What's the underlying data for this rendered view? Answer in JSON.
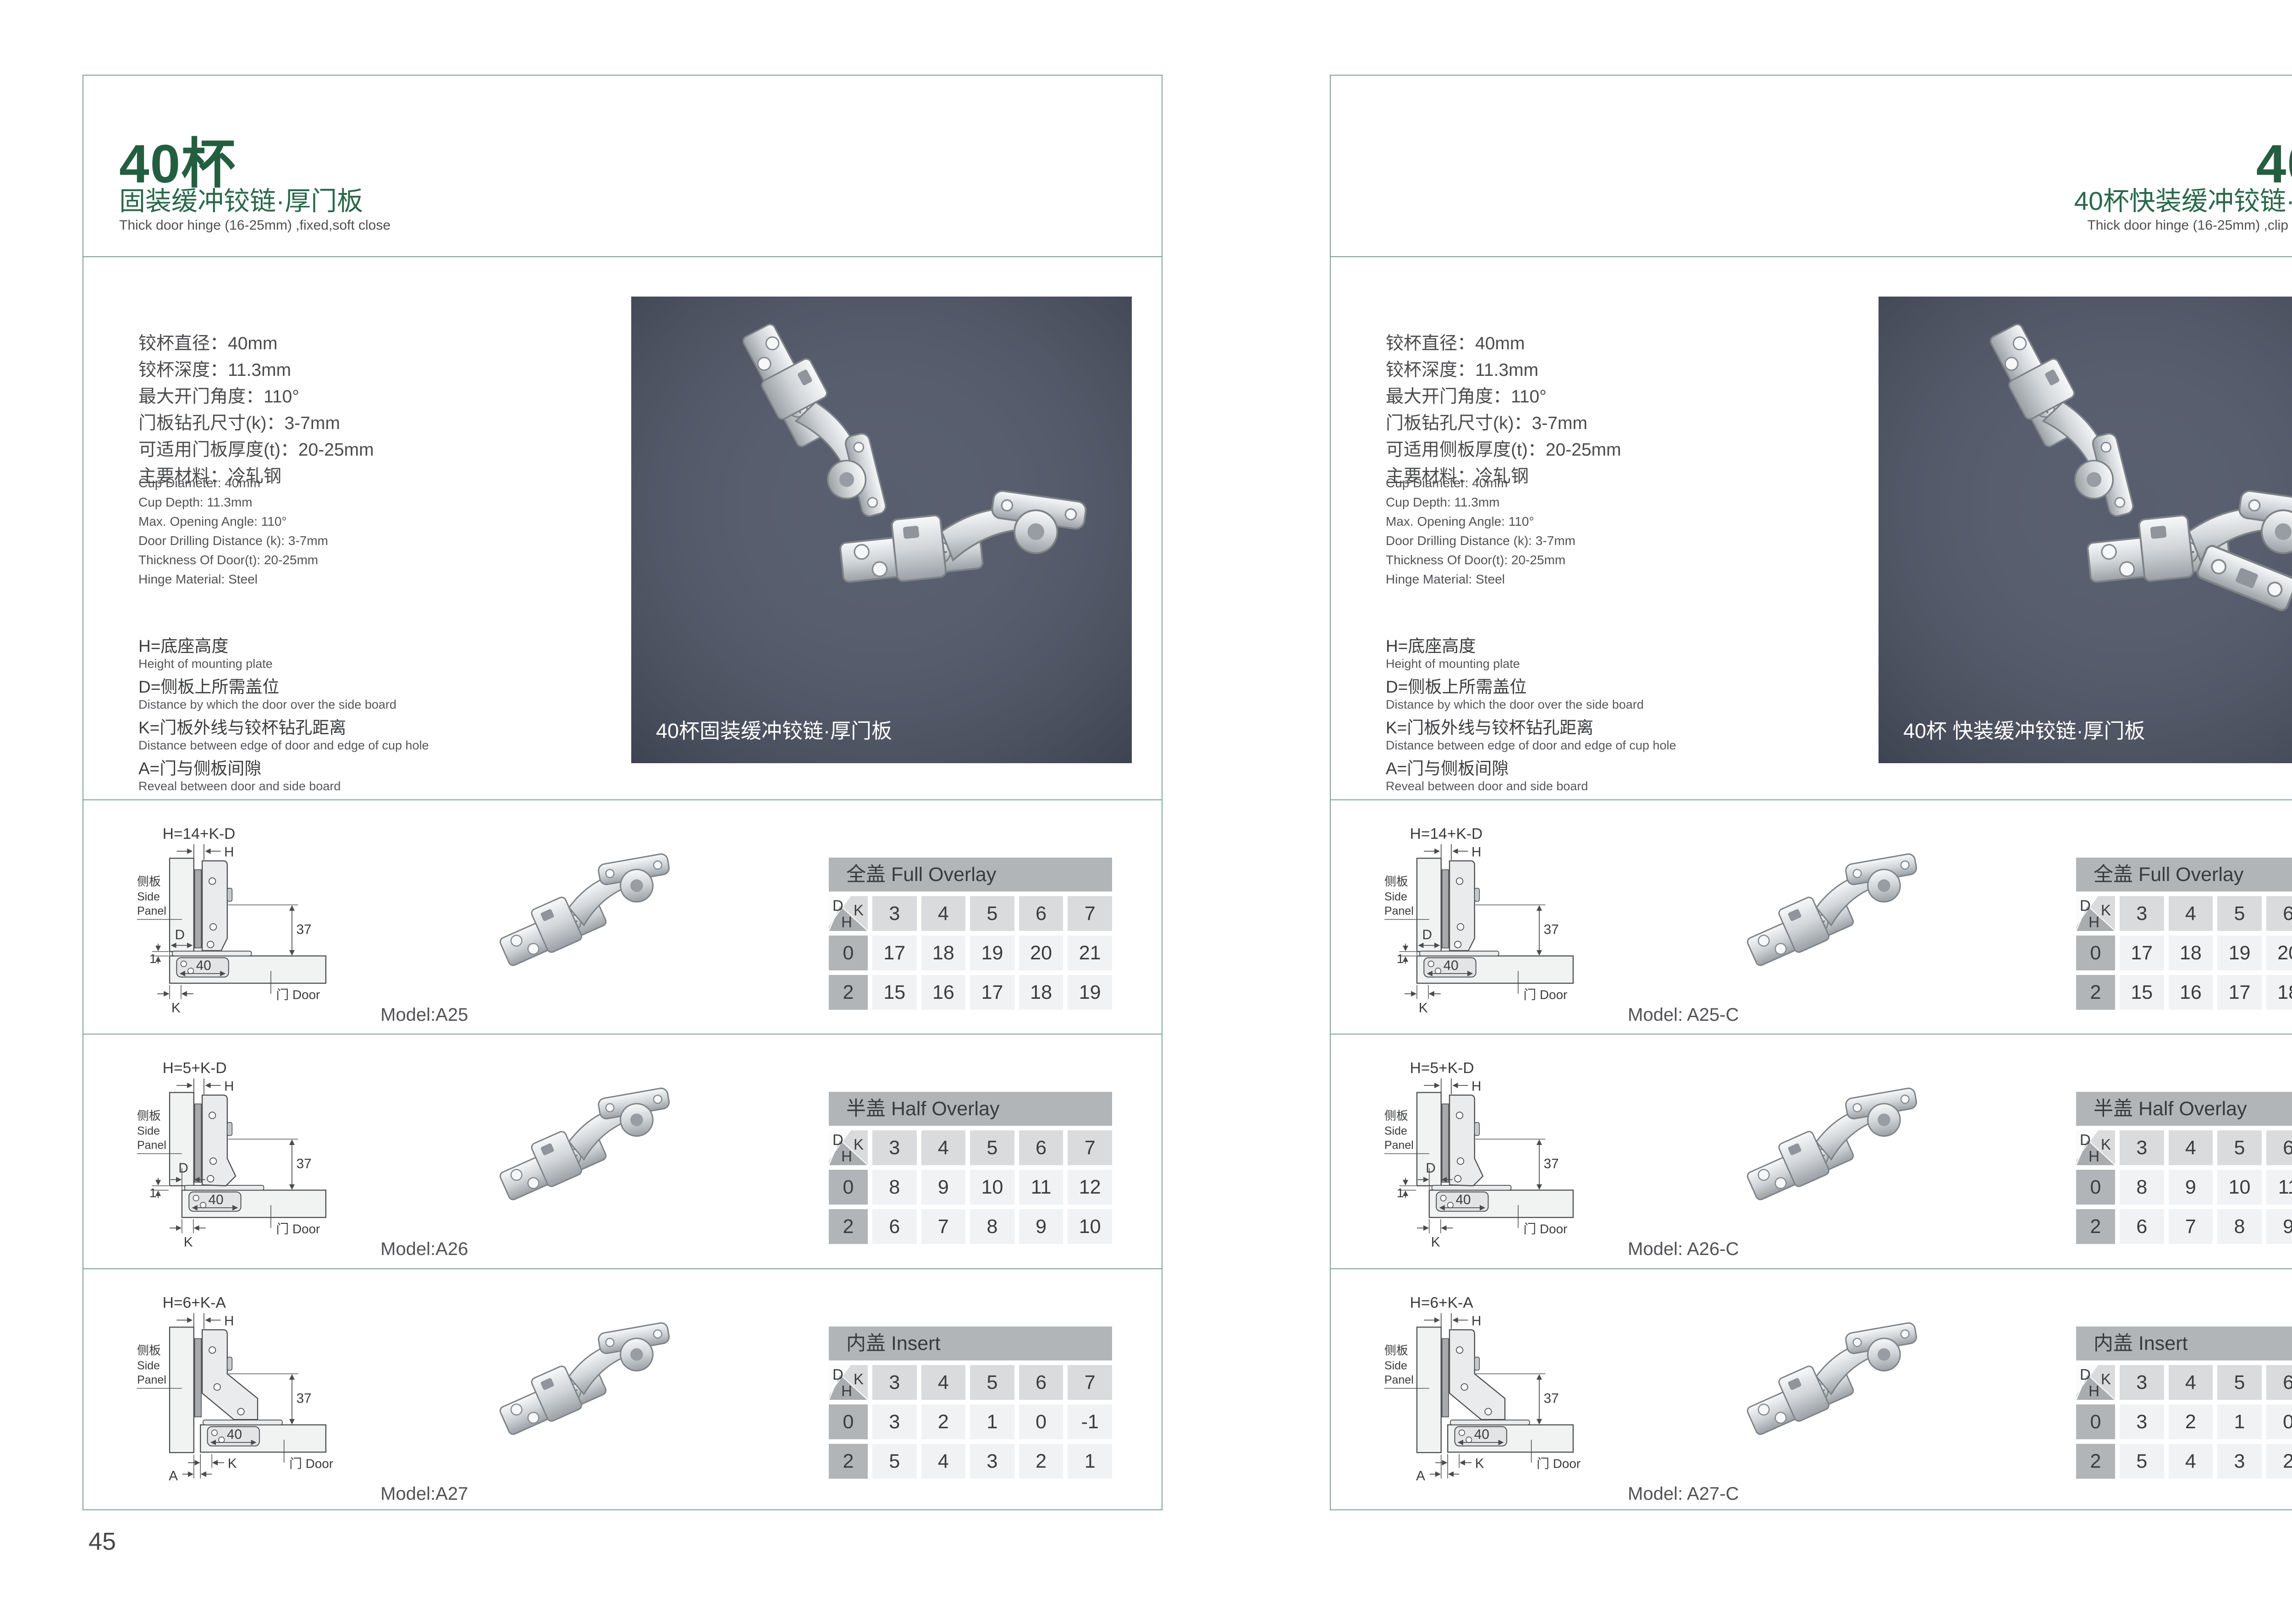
{
  "colors": {
    "accent_green": "#245e41",
    "border_green": "#7ca391",
    "photo_bg": "#4e5566",
    "table_title_bg": "#b1b5b8",
    "table_header_bg": "#d9dbdc",
    "table_label_bg": "#b1b5b8",
    "table_cell_bg": "#f1f2f3"
  },
  "pages": [
    {
      "page_number": "45",
      "title": "40杯",
      "subtitle": "固装缓冲铰链·厚门板",
      "subtitle_en": "Thick door hinge (16-25mm)  ,fixed,soft close",
      "specs_cn": [
        "铰杯直径：40mm",
        "铰杯深度：11.3mm",
        "最大开门角度：110°",
        "门板钻孔尺寸(k)：3-7mm",
        "可适用门板厚度(t)：20-25mm",
        "主要材料：冷轧钢"
      ],
      "specs_en": [
        "Cup Diameter: 40mm",
        "Cup Depth: 11.3mm",
        "Max. Opening Angle: 110°",
        "Door Drilling Distance (k): 3-7mm",
        "Thickness Of Door(t): 20-25mm",
        "Hinge Material: Steel"
      ],
      "legend": [
        {
          "cn": "H=底座高度",
          "en": "Height of mounting plate"
        },
        {
          "cn": "D=侧板上所需盖位",
          "en": "Distance by which the door over the side board"
        },
        {
          "cn": "K=门板外线与铰杯钻孔距离",
          "en": "Distance between edge of door and edge of cup hole"
        },
        {
          "cn": "A=门与侧板间隙",
          "en": "Reveal between door and side board"
        }
      ],
      "photo_caption": "40杯固装缓冲铰链·厚门板",
      "hinge_type": "fixed",
      "rows": [
        {
          "formula": "H=14+K-D",
          "model": "Model:A25",
          "diagram": "full-overlay",
          "table": {
            "title": "全盖 Full Overlay",
            "k_values": [
              "3",
              "4",
              "5",
              "6",
              "7"
            ],
            "rows": [
              {
                "h": "0",
                "values": [
                  "17",
                  "18",
                  "19",
                  "20",
                  "21"
                ]
              },
              {
                "h": "2",
                "values": [
                  "15",
                  "16",
                  "17",
                  "18",
                  "19"
                ]
              }
            ]
          }
        },
        {
          "formula": "H=5+K-D",
          "model": "Model:A26",
          "diagram": "half-overlay",
          "table": {
            "title": "半盖 Half Overlay",
            "k_values": [
              "3",
              "4",
              "5",
              "6",
              "7"
            ],
            "rows": [
              {
                "h": "0",
                "values": [
                  "8",
                  "9",
                  "10",
                  "11",
                  "12"
                ]
              },
              {
                "h": "2",
                "values": [
                  "6",
                  "7",
                  "8",
                  "9",
                  "10"
                ]
              }
            ]
          }
        },
        {
          "formula": "H=6+K-A",
          "model": "Model:A27",
          "diagram": "insert",
          "table": {
            "title": "内盖 Insert",
            "k_values": [
              "3",
              "4",
              "5",
              "6",
              "7"
            ],
            "rows": [
              {
                "h": "0",
                "values": [
                  "3",
                  "2",
                  "1",
                  "0",
                  "-1"
                ]
              },
              {
                "h": "2",
                "values": [
                  "5",
                  "4",
                  "3",
                  "2",
                  "1"
                ]
              }
            ]
          }
        }
      ]
    },
    {
      "page_number": "46",
      "title": "40杯",
      "subtitle": "40杯快装缓冲铰链·厚门板",
      "subtitle_en": "Thick door hinge (16-25mm)  ,clip on ,soft close",
      "specs_cn": [
        "铰杯直径：40mm",
        "铰杯深度：11.3mm",
        "最大开门角度：110°",
        "门板钻孔尺寸(k)：3-7mm",
        "可适用侧板厚度(t)：20-25mm",
        "主要材料：冷轧钢"
      ],
      "specs_en": [
        "Cup Diameter: 40mm",
        "Cup Depth: 11.3mm",
        "Max. Opening Angle: 110°",
        "Door Drilling Distance (k): 3-7mm",
        "Thickness Of Door(t): 20-25mm",
        "Hinge Material: Steel"
      ],
      "legend": [
        {
          "cn": "H=底座高度",
          "en": "Height of mounting plate"
        },
        {
          "cn": "D=侧板上所需盖位",
          "en": "Distance by which the door over the side board"
        },
        {
          "cn": "K=门板外线与铰杯钻孔距离",
          "en": "Distance between edge of door and edge of cup hole"
        },
        {
          "cn": "A=门与侧板间隙",
          "en": "Reveal between door and side board"
        }
      ],
      "photo_caption": "40杯 快装缓冲铰链·厚门板",
      "hinge_type": "clip",
      "rows": [
        {
          "formula": "H=14+K-D",
          "model": "Model: A25-C",
          "diagram": "full-overlay",
          "table": {
            "title": "全盖 Full Overlay",
            "k_values": [
              "3",
              "4",
              "5",
              "6",
              "7"
            ],
            "rows": [
              {
                "h": "0",
                "values": [
                  "17",
                  "18",
                  "19",
                  "20",
                  "21"
                ]
              },
              {
                "h": "2",
                "values": [
                  "15",
                  "16",
                  "17",
                  "18",
                  "19"
                ]
              }
            ]
          }
        },
        {
          "formula": "H=5+K-D",
          "model": "Model: A26-C",
          "diagram": "half-overlay",
          "table": {
            "title": "半盖 Half Overlay",
            "k_values": [
              "3",
              "4",
              "5",
              "6",
              "7"
            ],
            "rows": [
              {
                "h": "0",
                "values": [
                  "8",
                  "9",
                  "10",
                  "11",
                  "12"
                ]
              },
              {
                "h": "2",
                "values": [
                  "6",
                  "7",
                  "8",
                  "9",
                  "10"
                ]
              }
            ]
          }
        },
        {
          "formula": "H=6+K-A",
          "model": "Model: A27-C",
          "diagram": "insert",
          "table": {
            "title": "内盖 Insert",
            "k_values": [
              "3",
              "4",
              "5",
              "6",
              "7"
            ],
            "rows": [
              {
                "h": "0",
                "values": [
                  "3",
                  "2",
                  "1",
                  "0",
                  "-1"
                ]
              },
              {
                "h": "2",
                "values": [
                  "5",
                  "4",
                  "3",
                  "2",
                  "1"
                ]
              }
            ]
          }
        }
      ]
    }
  ],
  "diagram_labels": {
    "side_panel_cn": "侧板",
    "side_panel_en_line1": "Side",
    "side_panel_en_line2": "Panel",
    "door": "门 Door",
    "h": "H",
    "d": "D",
    "k": "K",
    "a": "A",
    "gap": "1",
    "height_37": "37",
    "width_40": "40"
  },
  "table_corner": {
    "d": "D",
    "k": "K",
    "h": "H"
  }
}
